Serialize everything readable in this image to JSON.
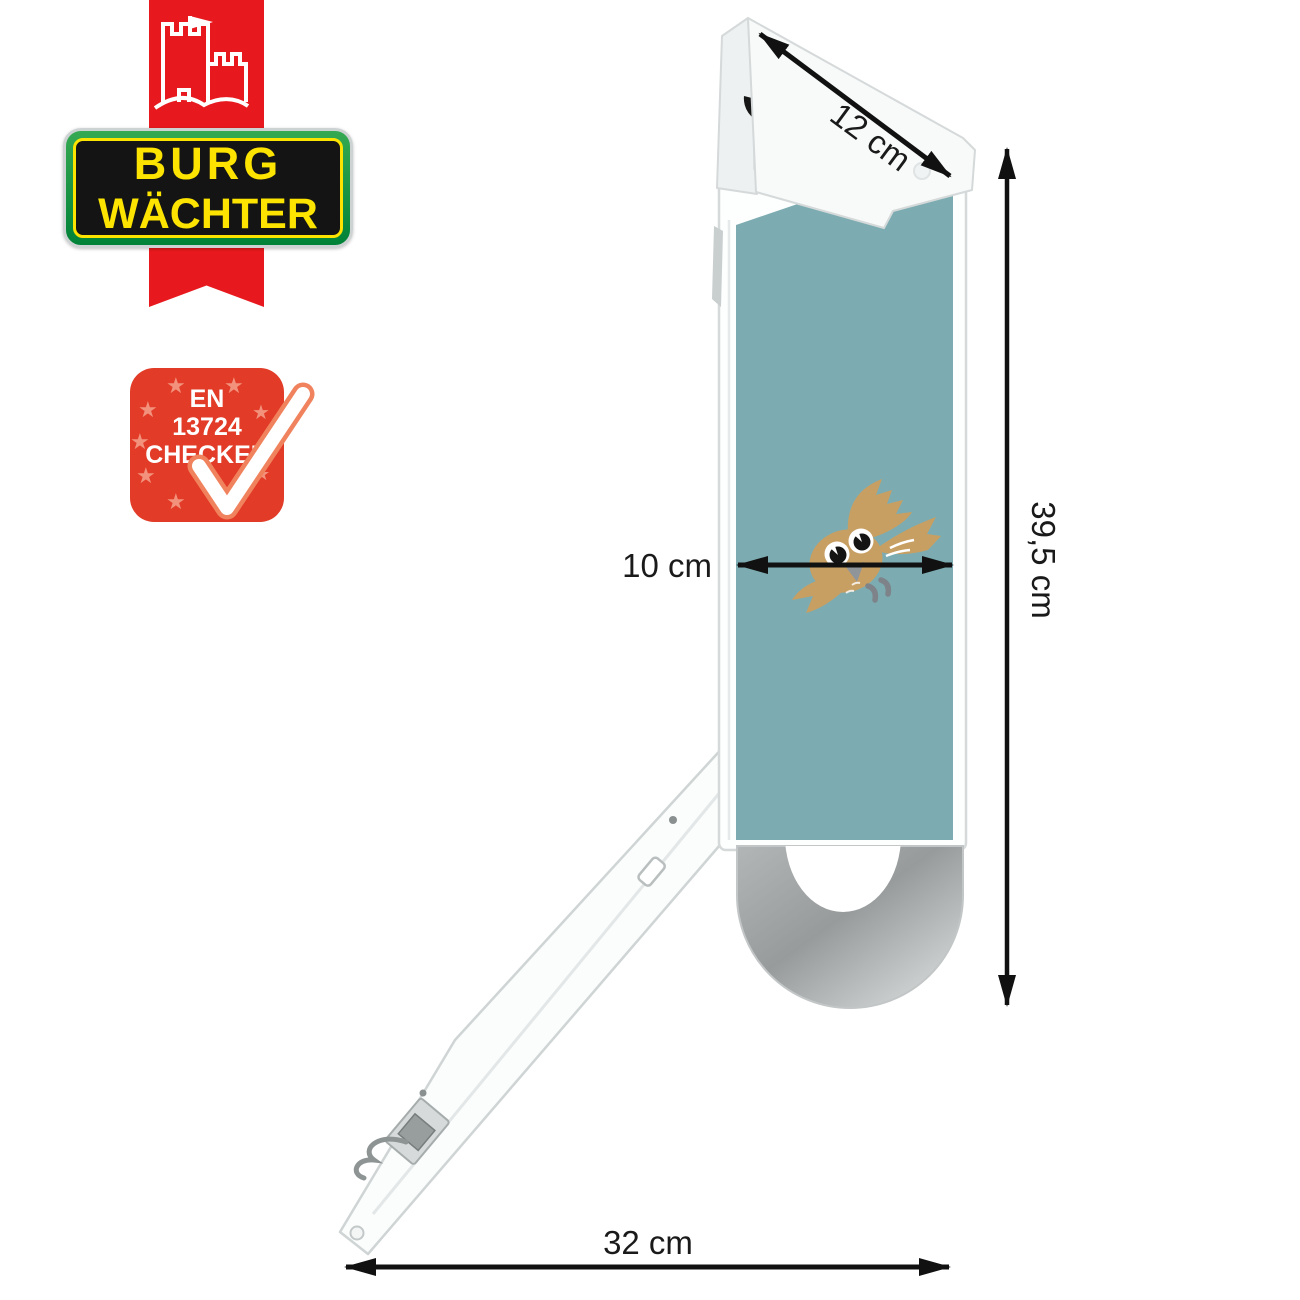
{
  "brand": {
    "line1": "BURG",
    "line2": "WÄCHTER"
  },
  "badge": {
    "line1": "EN",
    "line2": "13724",
    "line3": "CHECKED"
  },
  "dimensions": {
    "roof_width": "12 cm",
    "panel_width": "10 cm",
    "total_height": "39,5 cm",
    "arm_length": "32 cm"
  },
  "colors": {
    "brand_red": "#e8191e",
    "brand_green": "#009a3d",
    "brand_yellow": "#fce400",
    "badge_red": "#e23b27",
    "panel_teal": "#7cacb1",
    "owl_tan": "#c89f63",
    "scoop_silver": "#a9acac"
  }
}
